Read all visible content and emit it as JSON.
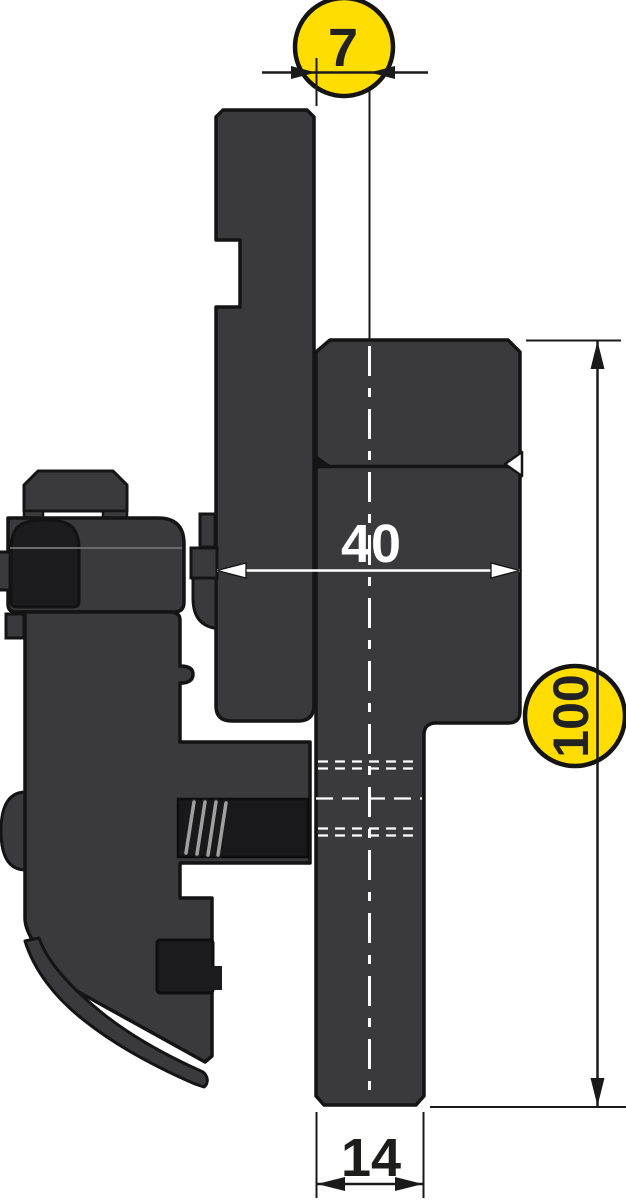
{
  "drawing": {
    "kind": "technical cross-section",
    "dimensions": {
      "top_offset": {
        "value": "7",
        "highlighted": true
      },
      "block_depth": {
        "value": "40",
        "highlighted": false
      },
      "tool_height": {
        "value": "100",
        "highlighted": true
      },
      "blade_thickness": {
        "value": "14",
        "highlighted": false
      }
    },
    "colors": {
      "highlight_yellow": "#ffdd00",
      "body_gray": "#3a393c",
      "dark_part": "#1c1b1d",
      "outline": "#141414",
      "dimension_black": "#1a1a1a",
      "dimension_white": "#ffffff"
    }
  }
}
